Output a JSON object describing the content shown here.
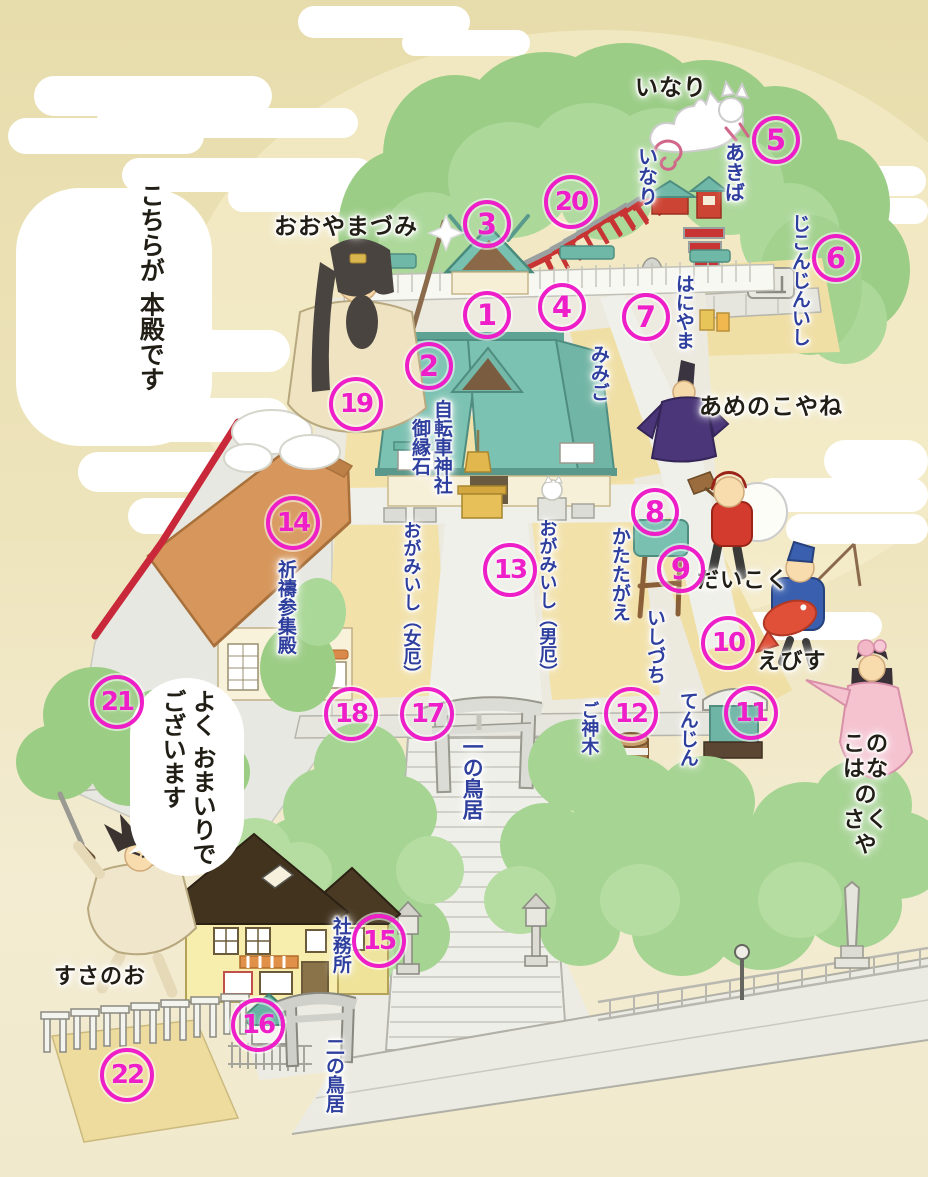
{
  "map": {
    "title": "shrine precinct illustrated map",
    "colors": {
      "marker_magenta": "#ee1fc8",
      "label_blue": "#2e3f9e",
      "label_black": "#211e16",
      "sky_tan": "#eadfb0",
      "tree_green": "#a6d493",
      "roof_teal": "#78c0b0",
      "torii_red": "#cc3333",
      "hall_roof_orange": "#d7975c",
      "house_yellow": "#f7eead",
      "sand": "#f2e1a8",
      "path_gray": "#efefea"
    },
    "bubble": {
      "text": "よく おまいりで\nございます"
    },
    "labels": [
      {
        "text": "いなり",
        "x": 671,
        "y": 88,
        "size": 23,
        "classes": "h black"
      },
      {
        "text": "いなり",
        "x": 646,
        "y": 176,
        "size": 20,
        "classes": "v blue"
      },
      {
        "text": "あきば",
        "x": 733,
        "y": 172,
        "size": 20,
        "classes": "v blue"
      },
      {
        "text": "じこんじんいし",
        "x": 799,
        "y": 280,
        "size": 19,
        "classes": "v blue"
      },
      {
        "text": "はにやま",
        "x": 683,
        "y": 312,
        "size": 19,
        "classes": "v blue"
      },
      {
        "text": "みみご",
        "x": 598,
        "y": 373,
        "size": 19,
        "classes": "v blue"
      },
      {
        "text": "あめのこやね",
        "x": 771,
        "y": 407,
        "size": 23,
        "classes": "h black"
      },
      {
        "text": "おおやまづみ",
        "x": 346,
        "y": 227,
        "size": 23,
        "classes": "h black"
      },
      {
        "text": "こちらが 本殿です",
        "x": 150,
        "y": 287,
        "size": 25,
        "classes": "v black"
      },
      {
        "text": "自転車神社\n御縁石",
        "x": 430,
        "y": 447,
        "size": 19,
        "classes": "v blue"
      },
      {
        "text": "かたたがえ",
        "x": 619,
        "y": 574,
        "size": 19,
        "classes": "v blue"
      },
      {
        "text": "いしづち",
        "x": 654,
        "y": 646,
        "size": 19,
        "classes": "v blue"
      },
      {
        "text": "てんじん",
        "x": 687,
        "y": 729,
        "size": 19,
        "classes": "v blue"
      },
      {
        "text": "だいこく",
        "x": 743,
        "y": 581,
        "size": 22,
        "classes": "h black"
      },
      {
        "text": "えびす",
        "x": 792,
        "y": 662,
        "size": 22,
        "classes": "h black"
      },
      {
        "text": "ご神木",
        "x": 588,
        "y": 728,
        "size": 18,
        "classes": "v blue"
      },
      {
        "text": "おがみいし（女厄）",
        "x": 410,
        "y": 602,
        "size": 18,
        "classes": "v blue"
      },
      {
        "text": "おがみいし（男厄）",
        "x": 546,
        "y": 600,
        "size": 18,
        "classes": "v blue"
      },
      {
        "text": "祈禱参集殿",
        "x": 285,
        "y": 607,
        "size": 19,
        "classes": "v blue"
      },
      {
        "text": "一の鳥居",
        "x": 472,
        "y": 778,
        "size": 21,
        "classes": "v blue"
      },
      {
        "text": "社務所",
        "x": 340,
        "y": 945,
        "size": 19,
        "classes": "v blue"
      },
      {
        "text": "二の鳥居",
        "x": 333,
        "y": 1075,
        "size": 19,
        "classes": "v blue"
      },
      {
        "text": "すさのお",
        "x": 100,
        "y": 977,
        "size": 22,
        "classes": "h black"
      },
      {
        "text": "このはなの\nさくや",
        "x": 866,
        "y": 795,
        "size": 22,
        "classes": "h black"
      }
    ],
    "markers": [
      {
        "n": "1",
        "x": 487,
        "y": 315,
        "classes": ""
      },
      {
        "n": "2",
        "x": 429,
        "y": 366,
        "classes": ""
      },
      {
        "n": "3",
        "x": 487,
        "y": 224,
        "classes": ""
      },
      {
        "n": "4",
        "x": 562,
        "y": 307,
        "classes": ""
      },
      {
        "n": "5",
        "x": 776,
        "y": 140,
        "classes": ""
      },
      {
        "n": "6",
        "x": 836,
        "y": 258,
        "classes": ""
      },
      {
        "n": "7",
        "x": 646,
        "y": 317,
        "classes": ""
      },
      {
        "n": "8",
        "x": 655,
        "y": 512,
        "classes": ""
      },
      {
        "n": "9",
        "x": 681,
        "y": 569,
        "classes": ""
      },
      {
        "n": "10",
        "x": 728,
        "y": 643,
        "classes": "two"
      },
      {
        "n": "11",
        "x": 751,
        "y": 713,
        "classes": "two"
      },
      {
        "n": "12",
        "x": 631,
        "y": 714,
        "classes": "two"
      },
      {
        "n": "13",
        "x": 510,
        "y": 570,
        "classes": "two"
      },
      {
        "n": "14",
        "x": 293,
        "y": 523,
        "classes": "two"
      },
      {
        "n": "15",
        "x": 379,
        "y": 941,
        "classes": "two"
      },
      {
        "n": "16",
        "x": 258,
        "y": 1025,
        "classes": "two"
      },
      {
        "n": "17",
        "x": 427,
        "y": 714,
        "classes": "two"
      },
      {
        "n": "18",
        "x": 351,
        "y": 714,
        "classes": "two"
      },
      {
        "n": "19",
        "x": 356,
        "y": 404,
        "classes": "two"
      },
      {
        "n": "20",
        "x": 571,
        "y": 202,
        "classes": "two"
      },
      {
        "n": "21",
        "x": 117,
        "y": 702,
        "classes": "two"
      },
      {
        "n": "22",
        "x": 127,
        "y": 1075,
        "classes": "two"
      }
    ]
  }
}
